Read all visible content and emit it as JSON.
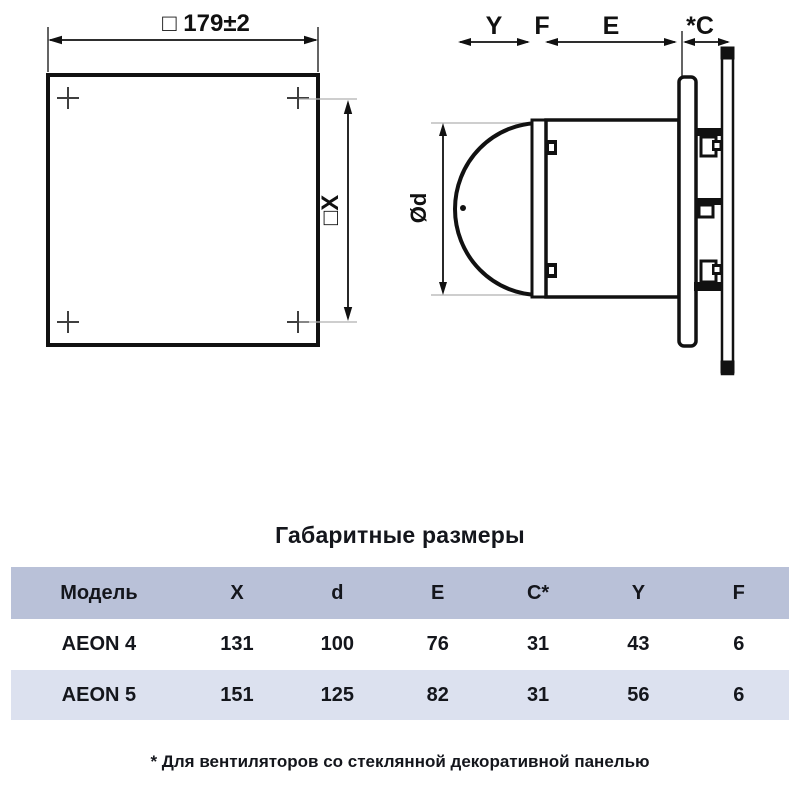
{
  "drawings": {
    "front_view": {
      "dim_width_label": "□ 179±2",
      "dim_height_label": "□X"
    },
    "side_view": {
      "dim_y_label": "Y",
      "dim_f_label": "F",
      "dim_e_label": "E",
      "dim_c_label": "*C",
      "dim_diameter_label": "Ød"
    }
  },
  "section_title": "Габаритные размеры",
  "table": {
    "headers": [
      "Модель",
      "X",
      "d",
      "E",
      "C*",
      "Y",
      "F"
    ],
    "rows": [
      {
        "model": "AEON 4",
        "values": [
          "131",
          "100",
          "76",
          "31",
          "43",
          "6"
        ]
      },
      {
        "model": "AEON 5",
        "values": [
          "151",
          "125",
          "82",
          "31",
          "56",
          "6"
        ]
      }
    ]
  },
  "footnote": "* Для вентиляторов со стеклянной декоративной панелью",
  "colors": {
    "table_header_bg": "#b9c1d8",
    "table_alt_row_bg": "#dce1ef",
    "line_color": "#111111",
    "text_color": "#14161c"
  }
}
